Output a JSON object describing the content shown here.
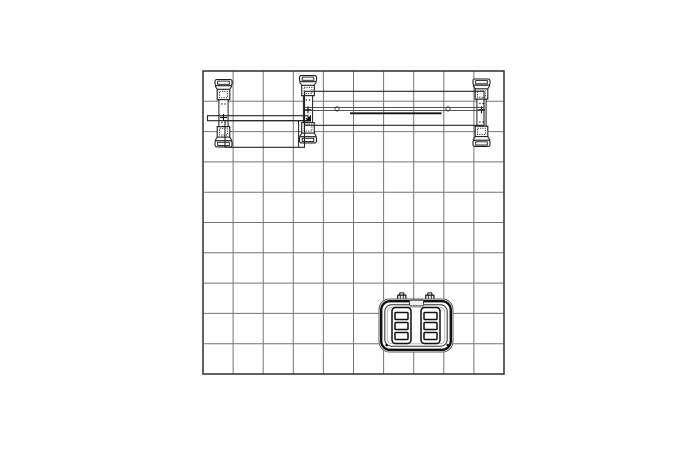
{
  "canvas": {
    "width": 700,
    "height": 450,
    "background": "#ffffff"
  },
  "diagram": {
    "kind": "technical-plan-view-drawing",
    "description": "Top-down plan drawing of a 10x10 display booth: back wall frame with three extrusion posts and horizontal beams along the top edge, a counter panel, and a molded shipping case on the floor grid",
    "colors": {
      "background": "#ffffff",
      "grid_line": "#757575",
      "grid_border": "#3a3a3a",
      "linework": "#1c1c1c",
      "rim_dark": "#101010",
      "rim_mid": "#2a2a2a",
      "rim_light": "#aaaaaa",
      "handle_fill": "#f0f0f0",
      "white": "#ffffff"
    },
    "grid": {
      "label": "booth-floor-grid-10x10",
      "x": 203,
      "y": 71,
      "width": 301,
      "height": 303,
      "columns": 10,
      "rows": 10
    },
    "posts": [
      {
        "label": "extrusion-post-left",
        "cx": 223.5,
        "top": 79.5,
        "cross_y": 117.5
      },
      {
        "label": "extrusion-post-center",
        "cx": 308.0,
        "top": 75.5,
        "cross_y": 109.8,
        "triangle_y": 118.5
      },
      {
        "label": "extrusion-post-right",
        "cx": 481.5,
        "top": 79.0,
        "cross_y": 109.8
      }
    ],
    "top_beam": {
      "label": "horizontal-beam-top",
      "x": 304.5,
      "y": 91.3,
      "width": 179.5,
      "height": 34,
      "channel_y1": 107.4,
      "channel_y2": 110.4,
      "connector_circles": [
        {
          "cx": 337,
          "cy": 108.9,
          "r": 2.1
        },
        {
          "cx": 448,
          "cy": 108.9,
          "r": 2.1
        }
      ],
      "graphic_bar": {
        "x1": 350,
        "x2": 441.5,
        "y": 113.3
      }
    },
    "left_beam": {
      "label": "horizontal-beam-left",
      "x": 207.5,
      "y": 115.7,
      "width": 100.5,
      "height": 5.0
    },
    "counter_panel": {
      "label": "counter-panel",
      "x": 225,
      "y": 120.7,
      "width": 79.5,
      "height": 26.6,
      "divider_x": 298.6
    },
    "case": {
      "label": "molded-shipping-case",
      "x": 379,
      "y": 299,
      "width": 74,
      "height": 53,
      "latch_cx": [
        401.8,
        429.8
      ],
      "handle": {
        "x": 409.5,
        "y": 300.3,
        "width": 14,
        "height": 5.6
      },
      "slat_group_y": 307.5,
      "slat_group_w": 19,
      "slat_group_h": 36,
      "slat_groups": [
        {
          "x": 392
        },
        {
          "x": 421
        }
      ],
      "rivets": [
        {
          "cx": 386.7,
          "cy": 345
        },
        {
          "cx": 447.7,
          "cy": 345
        }
      ]
    }
  }
}
